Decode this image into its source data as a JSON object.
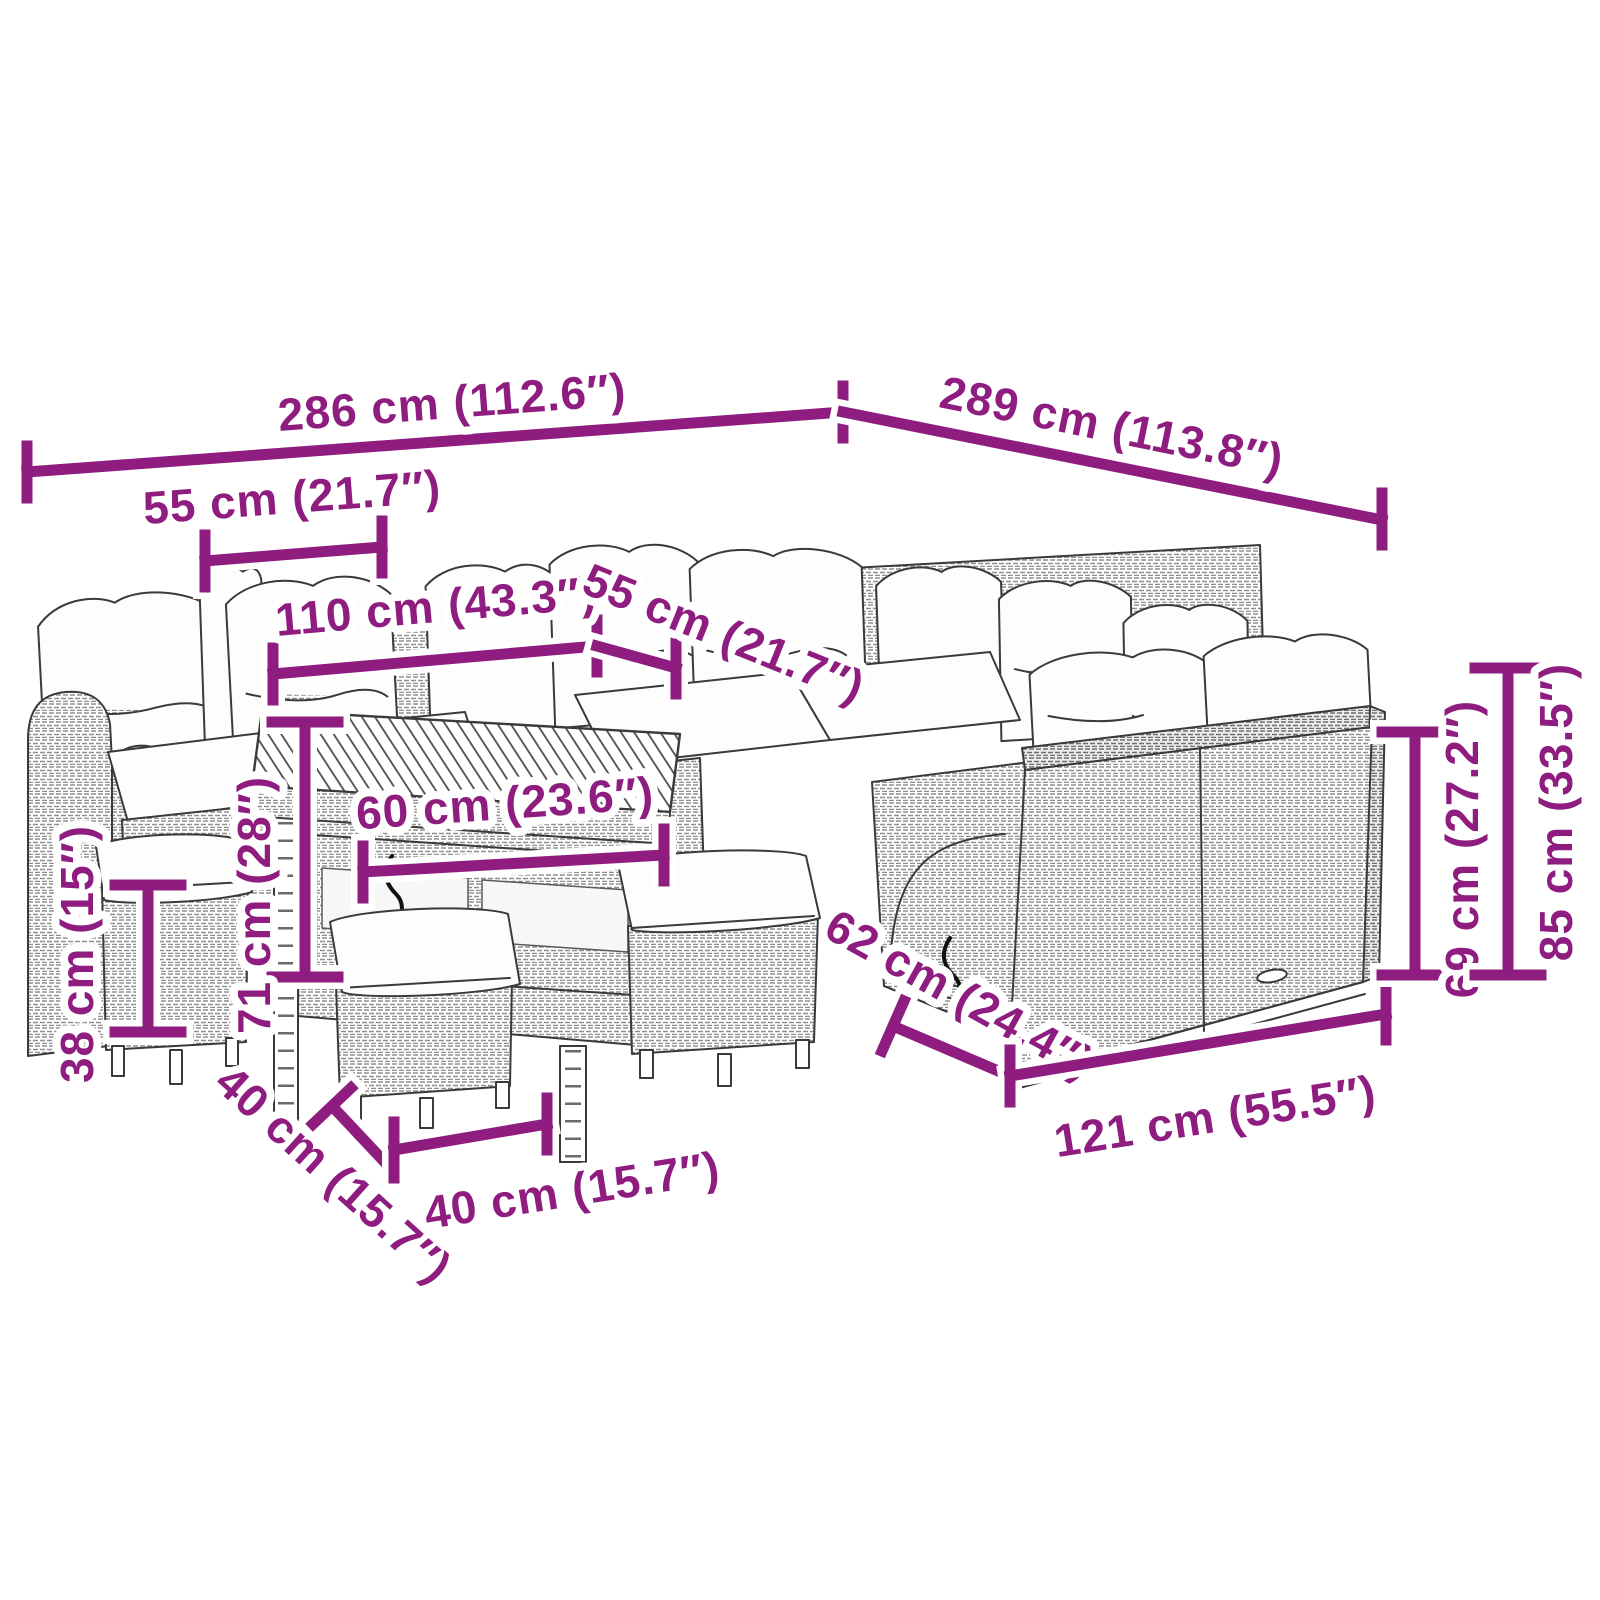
{
  "title": "Garden furniture set dimension diagram",
  "colors": {
    "dimension": "#8e1d7f",
    "outline": "#3a3a3a",
    "halo": "#ffffff"
  },
  "dimensions": {
    "width_total": "286 cm (112.6″)",
    "depth_total": "289 cm (113.8″)",
    "seat_width": "55 cm (21.7″)",
    "table_length": "110 cm (43.3″)",
    "seat_depth": "55 cm (21.7″)",
    "table_width": "60 cm (23.6″)",
    "table_height": "71 cm (28″)",
    "stool_height": "38 cm (15″)",
    "stool_depth": "40 cm (15.7″)",
    "stool_width": "40 cm (15.7″)",
    "sofa_depth": "62 cm (24.4″)",
    "sofa_width": "121 cm (55.5″)",
    "backrest_height": "69 cm (27.2″)",
    "height_total": "85 cm (33.5″)"
  }
}
